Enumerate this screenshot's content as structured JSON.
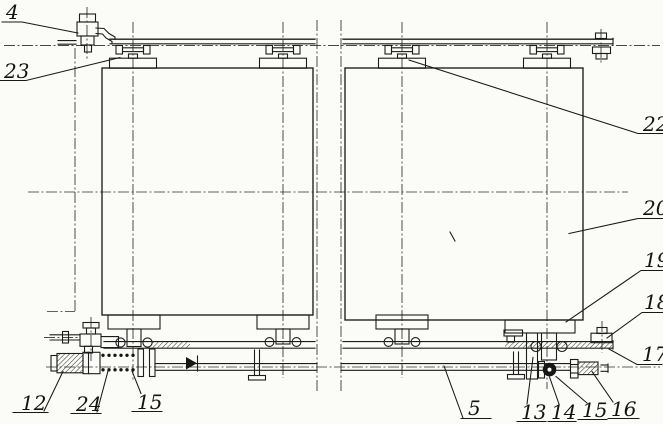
{
  "colors": {
    "paper": "#fbfbf8",
    "ink": "#1c1c1c"
  },
  "callouts": {
    "n4": {
      "label": "4"
    },
    "n23": {
      "label": "23"
    },
    "n22": {
      "label": "22"
    },
    "n20": {
      "label": "20"
    },
    "n19": {
      "label": "19"
    },
    "n18": {
      "label": "18"
    },
    "n17": {
      "label": "17"
    },
    "n16": {
      "label": "16"
    },
    "n15b": {
      "label": "15"
    },
    "n14": {
      "label": "14"
    },
    "n13": {
      "label": "13"
    },
    "n5": {
      "label": "5"
    },
    "n15a": {
      "label": "15"
    },
    "n24": {
      "label": "24"
    },
    "n12": {
      "label": "12"
    }
  }
}
